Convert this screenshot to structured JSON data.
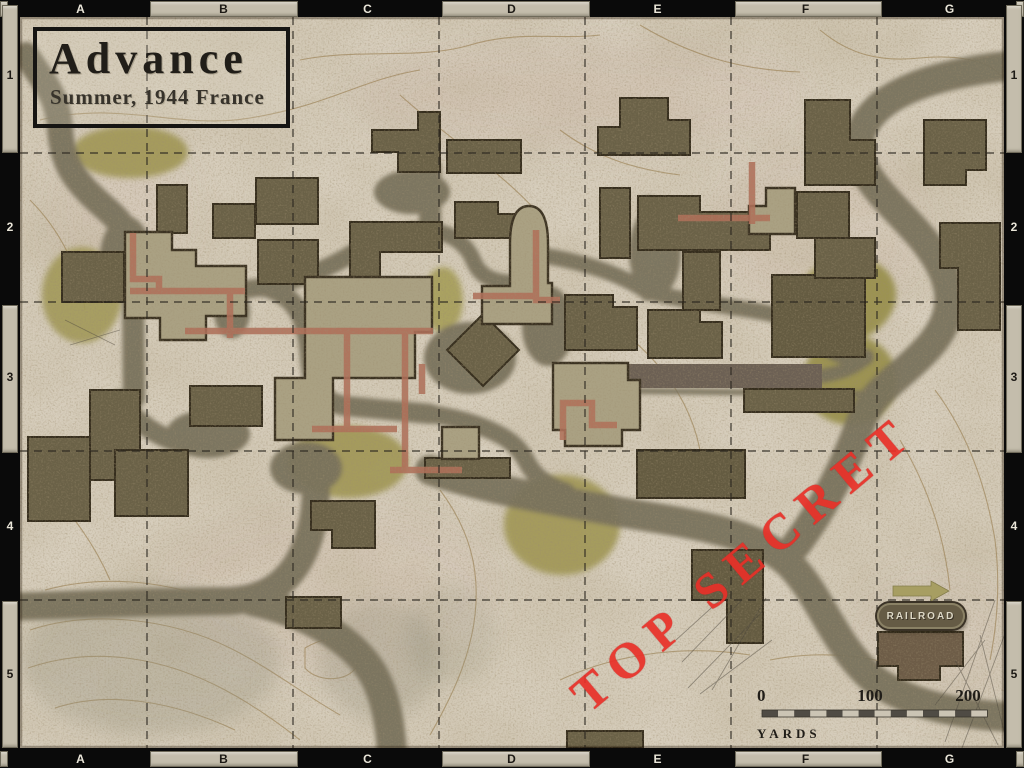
{
  "map_title": {
    "title": "Advance",
    "subtitle": "Summer, 1944 France"
  },
  "stamp": {
    "text": "TOP SECRET",
    "color": "#e93028"
  },
  "railroad": {
    "label": "RAILROAD"
  },
  "scale_bar": {
    "ticks": [
      "0",
      "100",
      "200"
    ],
    "unit_label": "YARDS"
  },
  "grid_index": {
    "columns": [
      "A",
      "B",
      "C",
      "D",
      "E",
      "F",
      "G"
    ],
    "rows": [
      "1",
      "2",
      "3",
      "4",
      "5"
    ]
  },
  "palette": {
    "border": "#0a0a0a",
    "tab": "#c4bdac",
    "parchment": "#d8cfbe",
    "road": "#78715c",
    "building_dark": "#6a6147",
    "building_light": "#aaa183",
    "vegetation": "#a29959",
    "trench": "#b06f59",
    "railroad_bar": "#6c6054",
    "stamp_red": "#e93028"
  }
}
